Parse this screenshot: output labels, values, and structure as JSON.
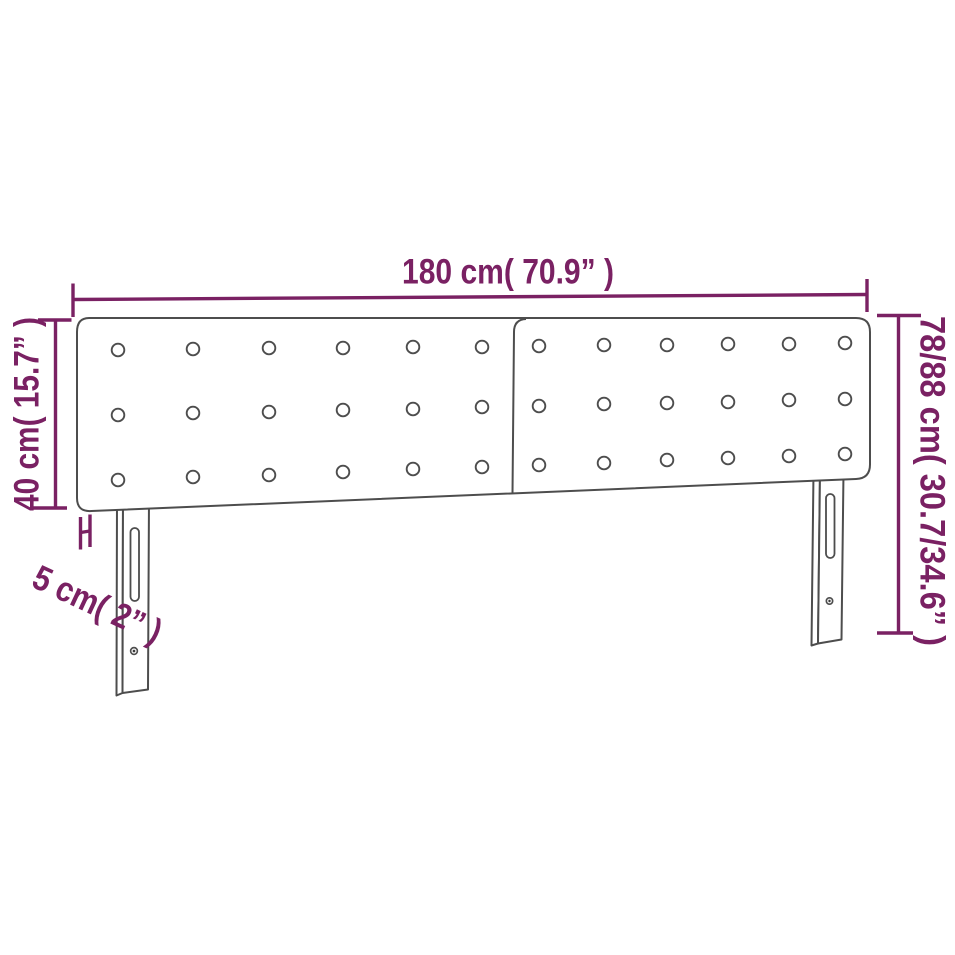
{
  "figure": {
    "type": "product-dimension-diagram",
    "subject": "upholstered headboard with two tufted panels and two legs"
  },
  "dimensions": {
    "width": {
      "label": "180 cm( 70.9” )",
      "cm": "180",
      "inches": "70.9"
    },
    "left_height": {
      "label": "40 cm( 15.7” )",
      "cm": "40",
      "inches": "15.7"
    },
    "right_height": {
      "label": "78/88 cm( 30.7/34.6” )",
      "cm": "78/88",
      "inches": "30.7/34.6"
    },
    "depth": {
      "label": "5 cm( 2” )",
      "cm": "5",
      "inches": "2"
    }
  },
  "colors": {
    "dimension": "#7a2163",
    "outline": "#4d4d4d",
    "background": "#ffffff"
  }
}
